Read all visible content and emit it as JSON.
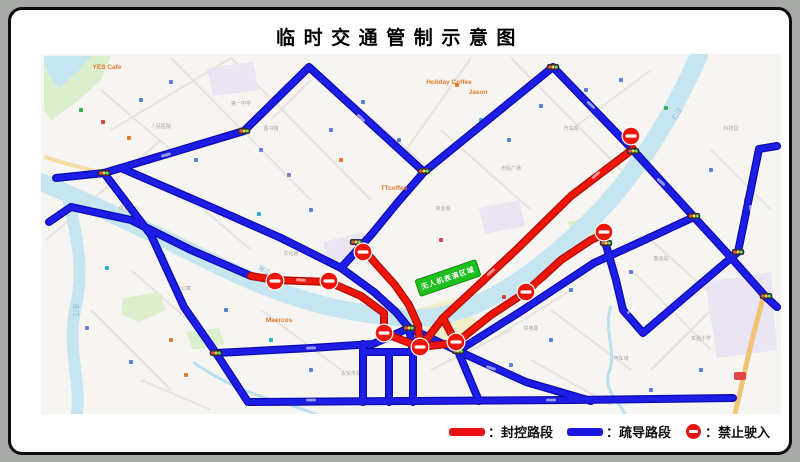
{
  "title": "临时交通管制示意图",
  "legend": {
    "items": [
      {
        "symbol": "red-bar",
        "label": "：封控路段",
        "color": "#e81212"
      },
      {
        "symbol": "blue-bar",
        "label": "：疏导路段",
        "color": "#1717dd"
      },
      {
        "symbol": "no-entry",
        "label": "：禁止驶入",
        "color": "#e81212"
      }
    ]
  },
  "map": {
    "colors": {
      "bg": "#f7f5f1",
      "river": "#c5e5f1",
      "stream": "#bcdfee",
      "park": "#dcefcc",
      "lavender": "#e9e5f3",
      "yellow_zone": "#f2eec8",
      "highway": "#f1c376",
      "tan_road": "#f3dca6",
      "blue_route": "#1d1de6",
      "blue_casing": "#0b0bb0",
      "red_route": "#ee1509",
      "red_casing": "#b00d08",
      "base_street": "#e7e3dd",
      "event_green": "#1fbf1f"
    },
    "event_zone": {
      "label": "无人机表演区域",
      "x": 437,
      "y": 268,
      "w": 64,
      "h": 17,
      "rotate": -19
    },
    "rivers": {
      "main": "M30,172 C60,185 120,212 200,252 C280,292 340,305 400,308 C460,310 520,268 575,215 C620,172 660,110 688,45",
      "tributary": "M58,192 C66,230 74,260 64,300 C56,340 70,370 66,404",
      "lake_topleft": "M33,46 L80,46 C70,60 58,70 48,78 C40,70 34,58 33,52 Z",
      "streams": [
        "M182,352 C210,372 240,384 262,390 C282,396 296,400 306,405",
        "M600,296 C592,320 606,342 598,362 C592,380 608,392 615,405"
      ],
      "labels": [
        {
          "text": "连江",
          "x": 63,
          "y": 300,
          "rotate": 90
        },
        {
          "text": "湘江",
          "x": 252,
          "y": 262,
          "rotate": 28
        },
        {
          "text": "湘江",
          "x": 470,
          "y": 278,
          "rotate": -38
        },
        {
          "text": "仁江",
          "x": 668,
          "y": 105,
          "rotate": -55
        }
      ]
    },
    "zones": {
      "parks": [
        "M33,46 L100,46 L90,70 L62,95 L40,110 L33,100 Z",
        "M112,288 L148,282 L155,300 L128,312 L110,304 Z",
        "M556,212 L586,206 L592,224 L566,232 Z",
        "M175,322 L208,318 L214,334 L182,340 Z"
      ],
      "lavender": [
        "M312,232 L352,222 L362,246 L320,258 Z",
        "M694,272 L760,262 L766,340 L706,348 Z",
        "M468,198 L508,190 L514,216 L474,224 Z",
        "M196,58 L242,52 L248,80 L202,86 Z"
      ],
      "yellow": [
        "M400,300 L447,288 L470,318 L432,338 Z"
      ]
    },
    "base_streets": [
      [
        160,
        48,
        300,
        190
      ],
      [
        220,
        48,
        360,
        190
      ],
      [
        100,
        120,
        220,
        48
      ],
      [
        35,
        230,
        150,
        130
      ],
      [
        460,
        48,
        395,
        140
      ],
      [
        500,
        48,
        620,
        170
      ],
      [
        430,
        120,
        520,
        200
      ],
      [
        620,
        260,
        700,
        340
      ],
      [
        640,
        230,
        740,
        320
      ],
      [
        480,
        330,
        560,
        280
      ],
      [
        250,
        300,
        330,
        360
      ],
      [
        120,
        260,
        200,
        330
      ],
      [
        80,
        300,
        160,
        380
      ],
      [
        420,
        360,
        500,
        320
      ],
      [
        540,
        300,
        620,
        360
      ],
      [
        640,
        360,
        700,
        300
      ],
      [
        90,
        80,
        160,
        140
      ],
      [
        350,
        100,
        420,
        160
      ],
      [
        560,
        120,
        640,
        60
      ],
      [
        700,
        140,
        760,
        200
      ],
      [
        170,
        180,
        240,
        240
      ],
      [
        300,
        70,
        260,
        110
      ],
      [
        520,
        350,
        600,
        395
      ],
      [
        130,
        370,
        200,
        400
      ]
    ],
    "highway": {
      "path": "M752,288 L741,330 L733,365 L724,404",
      "shield": {
        "x": 723,
        "y": 362
      }
    },
    "tan_roads": [
      "M33,147 C50,152 70,158 92,163"
    ],
    "routes": {
      "blue": [
        [
          [
            45,
            168
          ],
          [
            93,
            163
          ],
          [
            233,
            121
          ],
          [
            298,
            57
          ],
          [
            413,
            162
          ],
          [
            542,
            57
          ],
          [
            622,
            140
          ],
          [
            683,
            207
          ],
          [
            716,
            243
          ],
          [
            755,
            287
          ],
          [
            766,
            297
          ]
        ],
        [
          [
            93,
            163
          ],
          [
            140,
            225
          ],
          [
            173,
            297
          ],
          [
            205,
            343
          ],
          [
            237,
            392
          ],
          [
            400,
            391
          ],
          [
            560,
            390
          ],
          [
            722,
            388
          ]
        ],
        [
          [
            110,
            158
          ],
          [
            200,
            197
          ],
          [
            270,
            228
          ],
          [
            330,
            258
          ],
          [
            363,
            282
          ],
          [
            385,
            302
          ],
          [
            398,
            318
          ]
        ],
        [
          [
            205,
            343
          ],
          [
            300,
            338
          ],
          [
            362,
            334
          ],
          [
            398,
            318
          ]
        ],
        [
          [
            352,
            334
          ],
          [
            352,
            392
          ]
        ],
        [
          [
            378,
            342
          ],
          [
            378,
            392
          ]
        ],
        [
          [
            398,
            318
          ],
          [
            402,
            342
          ],
          [
            402,
            392
          ]
        ],
        [
          [
            352,
            342
          ],
          [
            402,
            342
          ]
        ],
        [
          [
            398,
            318
          ],
          [
            447,
            341
          ],
          [
            515,
            372
          ],
          [
            580,
            391
          ]
        ],
        [
          [
            447,
            341
          ],
          [
            468,
            391
          ]
        ],
        [
          [
            595,
            235
          ],
          [
            605,
            270
          ],
          [
            612,
            300
          ],
          [
            632,
            323
          ],
          [
            680,
            282
          ],
          [
            727,
            242
          ],
          [
            748,
            139
          ],
          [
            766,
            136
          ]
        ],
        [
          [
            413,
            162
          ],
          [
            387,
            192
          ],
          [
            360,
            225
          ],
          [
            330,
            258
          ]
        ],
        [
          [
            447,
            341
          ],
          [
            512,
            300
          ],
          [
            583,
            253
          ],
          [
            640,
            227
          ],
          [
            683,
            207
          ]
        ],
        [
          [
            38,
            212
          ],
          [
            60,
            197
          ],
          [
            120,
            210
          ],
          [
            180,
            240
          ],
          [
            240,
            266
          ]
        ]
      ],
      "red": [
        [
          [
            622,
            139
          ],
          [
            560,
            186
          ],
          [
            505,
            240
          ],
          [
            460,
            282
          ],
          [
            432,
            308
          ],
          [
            415,
            330
          ]
        ],
        [
          [
            240,
            266
          ],
          [
            264,
            270
          ],
          [
            318,
            272
          ],
          [
            350,
            286
          ],
          [
            373,
            303
          ],
          [
            373,
            323
          ]
        ],
        [
          [
            373,
            323
          ],
          [
            409,
            337
          ],
          [
            445,
            333
          ]
        ],
        [
          [
            445,
            333
          ],
          [
            432,
            308
          ]
        ],
        [
          [
            348,
            234
          ],
          [
            366,
            255
          ],
          [
            384,
            275
          ],
          [
            398,
            295
          ],
          [
            407,
            315
          ],
          [
            409,
            337
          ]
        ],
        [
          [
            445,
            333
          ],
          [
            480,
            305
          ],
          [
            515,
            282
          ],
          [
            550,
            250
          ],
          [
            580,
            230
          ],
          [
            593,
            224
          ]
        ]
      ]
    },
    "road_marks": [
      {
        "x": 155,
        "y": 145,
        "r": -16
      },
      {
        "x": 265,
        "y": 100,
        "r": -30
      },
      {
        "x": 350,
        "y": 108,
        "r": 45
      },
      {
        "x": 470,
        "y": 105,
        "r": -42
      },
      {
        "x": 580,
        "y": 95,
        "r": 42
      },
      {
        "x": 650,
        "y": 172,
        "r": 42
      },
      {
        "x": 160,
        "y": 250,
        "r": 55
      },
      {
        "x": 300,
        "y": 390,
        "r": 0
      },
      {
        "x": 540,
        "y": 390,
        "r": 0
      },
      {
        "x": 620,
        "y": 300,
        "r": -45
      },
      {
        "x": 740,
        "y": 200,
        "r": 80
      },
      {
        "x": 300,
        "y": 338,
        "r": -2
      },
      {
        "x": 480,
        "y": 358,
        "r": 20
      },
      {
        "x": 530,
        "y": 275,
        "r": -38
      },
      {
        "x": 585,
        "y": 165,
        "r": -42
      },
      {
        "x": 480,
        "y": 262,
        "r": -42
      },
      {
        "x": 290,
        "y": 270,
        "r": 5
      }
    ],
    "no_entry_points": [
      [
        620,
        126
      ],
      [
        593,
        222
      ],
      [
        352,
        242
      ],
      [
        264,
        271
      ],
      [
        318,
        271
      ],
      [
        373,
        323
      ],
      [
        409,
        337
      ],
      [
        445,
        332
      ],
      [
        515,
        282
      ]
    ],
    "traffic_lights": [
      [
        93,
        163
      ],
      [
        233,
        121
      ],
      [
        413,
        161
      ],
      [
        542,
        57
      ],
      [
        622,
        141
      ],
      [
        683,
        206
      ],
      [
        595,
        233
      ],
      [
        755,
        286
      ],
      [
        345,
        232
      ],
      [
        398,
        318
      ],
      [
        447,
        341
      ],
      [
        205,
        343
      ],
      [
        727,
        242
      ]
    ],
    "poi_labels": [
      {
        "text": "YES Cafe",
        "x": 96,
        "y": 59,
        "color": "#e07a30"
      },
      {
        "text": "Holiday Coffee",
        "x": 438,
        "y": 74,
        "color": "#e07a30"
      },
      {
        "text": "TTcoffee",
        "x": 383,
        "y": 180,
        "color": "#e07a30"
      },
      {
        "text": "Jason",
        "x": 467,
        "y": 84,
        "color": "#e07a30"
      },
      {
        "text": "Maercos",
        "x": 268,
        "y": 312,
        "color": "#e07a30"
      }
    ],
    "generic_labels": [
      {
        "text": "市民广场",
        "x": 500,
        "y": 160
      },
      {
        "text": "第一中学",
        "x": 230,
        "y": 95
      },
      {
        "text": "人民医院",
        "x": 150,
        "y": 118
      },
      {
        "text": "体育中心",
        "x": 118,
        "y": 200
      },
      {
        "text": "汽车站",
        "x": 560,
        "y": 120
      },
      {
        "text": "商业城",
        "x": 432,
        "y": 200
      },
      {
        "text": "客运站",
        "x": 650,
        "y": 250
      },
      {
        "text": "实验小学",
        "x": 690,
        "y": 330
      },
      {
        "text": "文化宫",
        "x": 280,
        "y": 245
      },
      {
        "text": "供电局",
        "x": 520,
        "y": 320
      },
      {
        "text": "农贸市场",
        "x": 340,
        "y": 365
      },
      {
        "text": "汽车城",
        "x": 610,
        "y": 350
      },
      {
        "text": "老年公寓",
        "x": 170,
        "y": 280
      },
      {
        "text": "图书馆",
        "x": 260,
        "y": 120
      },
      {
        "text": "科技园",
        "x": 720,
        "y": 120
      }
    ],
    "poi_dots": [
      [
        70,
        100,
        "#3aa757"
      ],
      [
        92,
        112,
        "#d44444"
      ],
      [
        130,
        90,
        "#5b7fd4"
      ],
      [
        160,
        72,
        "#5b7fd4"
      ],
      [
        118,
        128,
        "#e07a30"
      ],
      [
        185,
        150,
        "#5b7fd4"
      ],
      [
        152,
        246,
        "#5b7fd4"
      ],
      [
        96,
        258,
        "#2ab3c9"
      ],
      [
        76,
        318,
        "#5b7fd4"
      ],
      [
        120,
        352,
        "#5b7fd4"
      ],
      [
        160,
        330,
        "#e07a30"
      ],
      [
        250,
        140,
        "#5b7fd4"
      ],
      [
        278,
        165,
        "#8a77c9"
      ],
      [
        320,
        120,
        "#5b7fd4"
      ],
      [
        352,
        92,
        "#5b7fd4"
      ],
      [
        300,
        200,
        "#5b7fd4"
      ],
      [
        248,
        204,
        "#2ab3c9"
      ],
      [
        388,
        130,
        "#5b7fd4"
      ],
      [
        446,
        75,
        "#e07a30"
      ],
      [
        470,
        110,
        "#2ab3c9"
      ],
      [
        498,
        130,
        "#5b7fd4"
      ],
      [
        530,
        96,
        "#5b7fd4"
      ],
      [
        575,
        80,
        "#5b7fd4"
      ],
      [
        610,
        70,
        "#5b7fd4"
      ],
      [
        655,
        98,
        "#3aa757"
      ],
      [
        700,
        160,
        "#5b7fd4"
      ],
      [
        735,
        190,
        "#5b7fd4"
      ],
      [
        560,
        280,
        "#5b7fd4"
      ],
      [
        620,
        262,
        "#5b7fd4"
      ],
      [
        660,
        300,
        "#5b7fd4"
      ],
      [
        690,
        360,
        "#5b7fd4"
      ],
      [
        640,
        380,
        "#5b7fd4"
      ],
      [
        540,
        330,
        "#5b7fd4"
      ],
      [
        500,
        355,
        "#5b7fd4"
      ],
      [
        300,
        360,
        "#5b7fd4"
      ],
      [
        260,
        330,
        "#2ab3c9"
      ],
      [
        215,
        300,
        "#5b7fd4"
      ],
      [
        430,
        230,
        "#d44444"
      ],
      [
        493,
        287,
        "#d44444"
      ],
      [
        228,
        375,
        "#5b7fd4"
      ],
      [
        175,
        365,
        "#e07a30"
      ],
      [
        330,
        150,
        "#e07a30"
      ]
    ]
  }
}
